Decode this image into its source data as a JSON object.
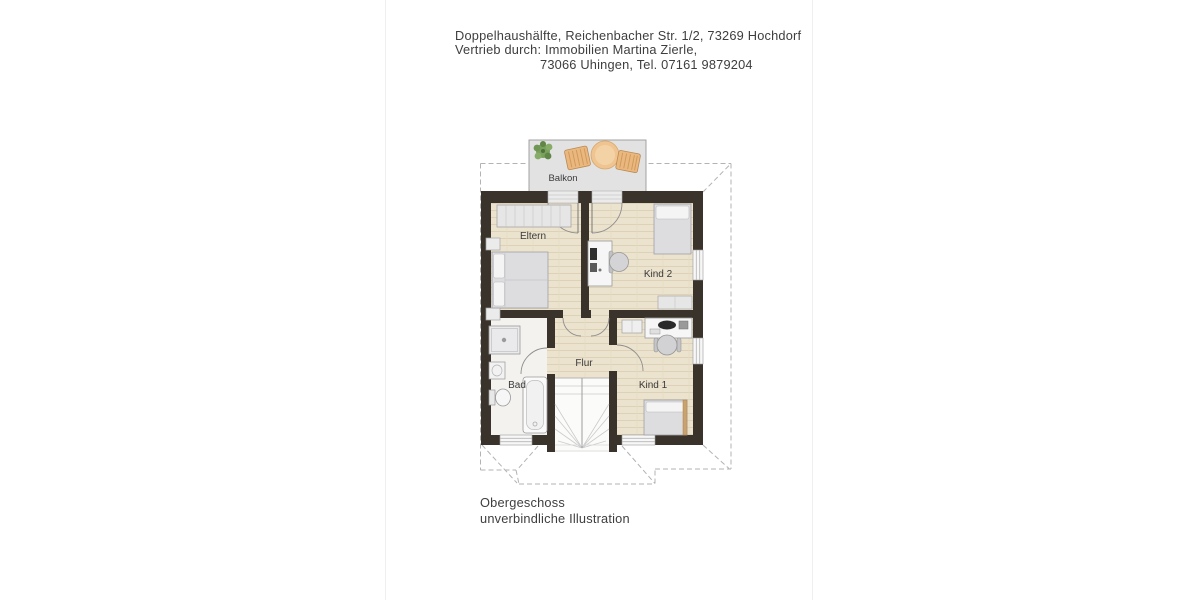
{
  "document": {
    "header": {
      "line1": "Doppelhaushälfte, Reichenbacher Str. 1/2, 73269 Hochdorf",
      "line2": "Vertrieb durch: Immobilien Martina Zierle,",
      "line3": "73066 Uhingen, Tel. 07161 9879204"
    },
    "footer": {
      "line1": "Obergeschoss",
      "line2": "unverbindliche Illustration"
    },
    "floorplan": {
      "room_labels": {
        "balkon": "Balkon",
        "eltern": "Eltern",
        "kind_2": "Kind 2",
        "bad": "Bad",
        "flur": "Flur",
        "kind_1": "Kind 1"
      },
      "colors": {
        "wall": "#3a332b",
        "wood_floor": "#ece3cf",
        "bath_floor": "#f3f2ef",
        "stairs": "#fbfbfa",
        "balcony": "#e2e2e2",
        "roof_dashed": "#b3b3b3",
        "furniture_gray": "#dddde0",
        "wicker_chair": "#eab87f",
        "table_wood": "#efc491",
        "plant_green": "#6f9655",
        "bed_frame_wood": "#c9a26d",
        "text": "#3e3e3e"
      }
    }
  }
}
